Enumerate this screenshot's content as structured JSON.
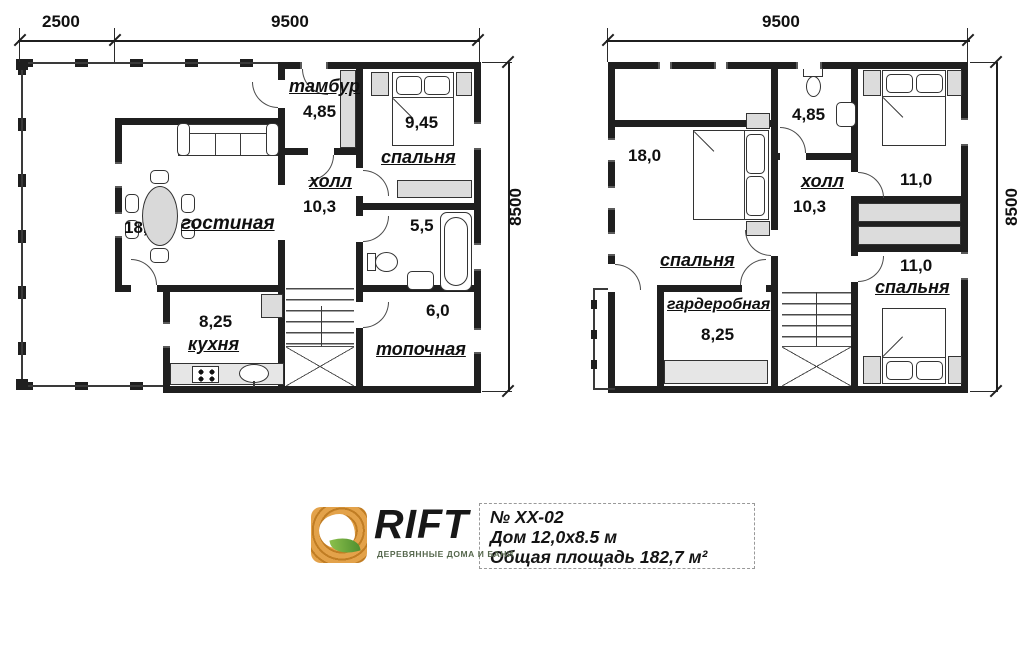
{
  "floor1": {
    "dims": {
      "terrace_width": "2500",
      "house_width": "9500",
      "house_depth": "8500"
    },
    "rooms": {
      "tambur": {
        "name": "тамбур",
        "area": "4,85"
      },
      "bedroom": {
        "name": "спальня",
        "area": "9,45"
      },
      "hall": {
        "name": "холл",
        "area": "10,3"
      },
      "living": {
        "name": "гостиная",
        "area": "18,0"
      },
      "kitchen": {
        "name": "кухня",
        "area": "8,25"
      },
      "bathroom": {
        "area": "5,5"
      },
      "boiler": {
        "name": "топочная",
        "area": "6,0"
      }
    }
  },
  "floor2": {
    "dims": {
      "house_width": "9500",
      "house_depth": "8500"
    },
    "rooms": {
      "bedroom_left": {
        "name": "спальня",
        "area": "18,0"
      },
      "bathroom": {
        "area": "4,85"
      },
      "hall": {
        "name": "холл",
        "area": "10,3"
      },
      "bedroom_top_right": {
        "area": "11,0"
      },
      "bedroom_bottom_right": {
        "name": "спальня",
        "area": "11,0"
      },
      "wardrobe": {
        "name": "гардеробная",
        "area": "8,25"
      }
    }
  },
  "footer": {
    "brand": {
      "name": "RIFT",
      "tagline": "ДЕРЕВЯННЫЕ ДОМА И БАНИ"
    },
    "info": {
      "project_no": "№ ХХ-02",
      "house_size": "Дом 12,0х8.5 м",
      "total_area": "Общая площадь 182,7 м²"
    }
  },
  "colors": {
    "wall": "#1f1f1f",
    "furniture_fill": "#dcdcdc",
    "logo_orange": "#dd9637",
    "logo_leaf_green": "#6aaa3c",
    "tagline_green": "#57684e",
    "text": "#101010"
  }
}
